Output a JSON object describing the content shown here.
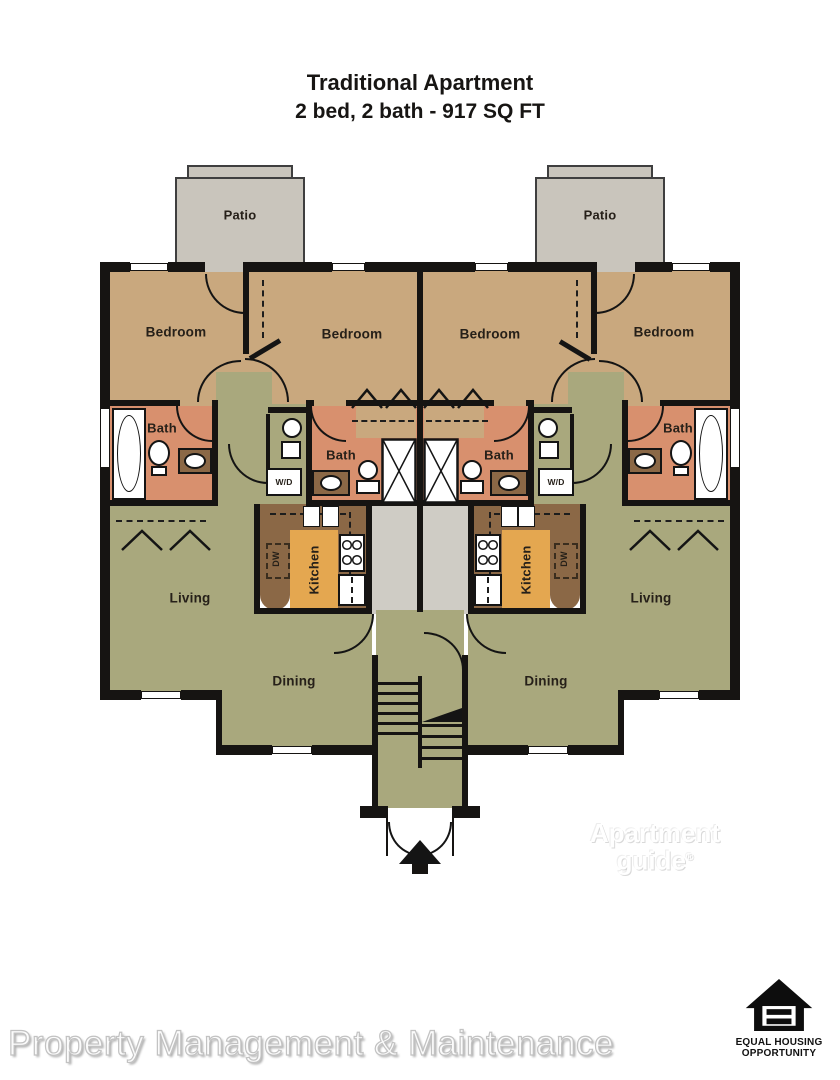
{
  "title": {
    "line1": "Traditional Apartment",
    "line2": "2 bed, 2 bath  - 917 SQ FT"
  },
  "labels": {
    "patio": "Patio",
    "bedroom": "Bedroom",
    "bath": "Bath",
    "kitchen": "Kitchen",
    "living": "Living",
    "dining": "Dining",
    "washer_dryer": "W/D",
    "dishwasher": "DW"
  },
  "watermark": {
    "line1": "Apartment",
    "line2": "guide",
    "registered": "®"
  },
  "footer": {
    "company": "Property Management & Maintenance"
  },
  "equal_housing": {
    "line1": "EQUAL HOUSING",
    "line2": "OPPORTUNITY"
  },
  "colors": {
    "bedroom": "#c9a87e",
    "bath": "#d8906e",
    "living": "#a9a87d",
    "kitchen": "#e4a750",
    "counter": "#8b6846",
    "patio": "#c9c5bc",
    "hallway": "#cfccc5",
    "wall": "#161412"
  }
}
